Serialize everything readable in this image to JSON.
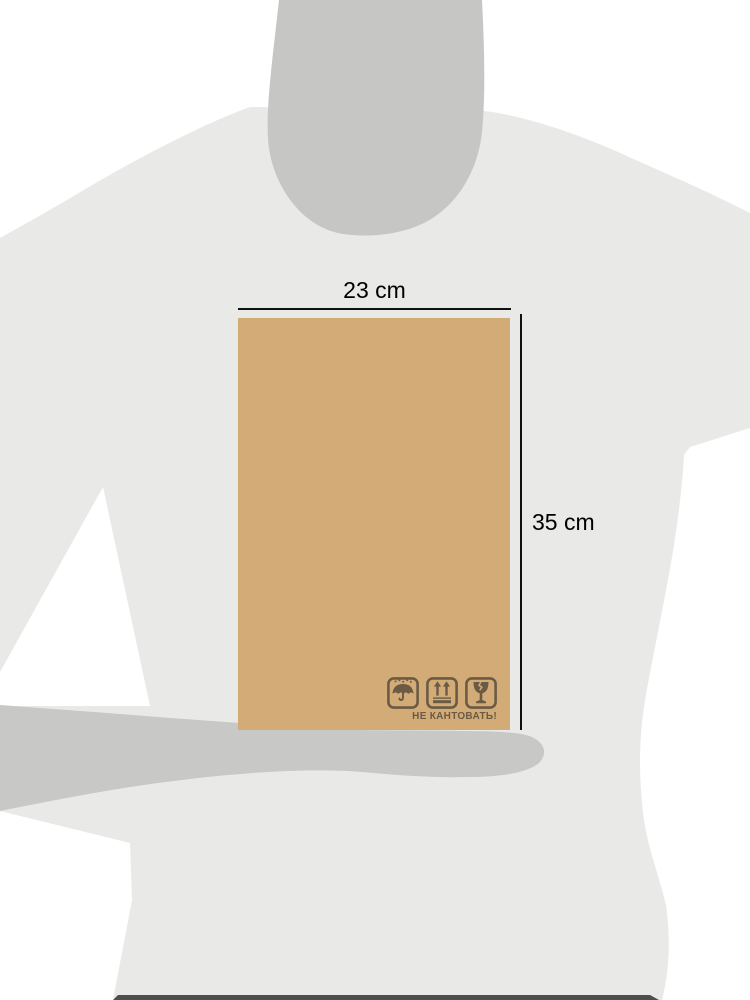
{
  "figure": {
    "description": "Person silhouette holding a cardboard parcel for size reference",
    "parcel": {
      "width_label": "23 cm",
      "height_label": "35 cm",
      "warning_text": "НЕ КАНТОВАТЬ!",
      "handling_icons": [
        "keep-dry",
        "this-side-up",
        "fragile"
      ]
    }
  },
  "colors": {
    "bg": "#ffffff",
    "body": "#e9e9e8",
    "head": "#c6c6c5",
    "arm": "#c8c8c7",
    "strip": "#4e4e4e",
    "box": "#d2ab77",
    "icon": "#6b5b45",
    "line": "#111111",
    "label": "#000000"
  }
}
